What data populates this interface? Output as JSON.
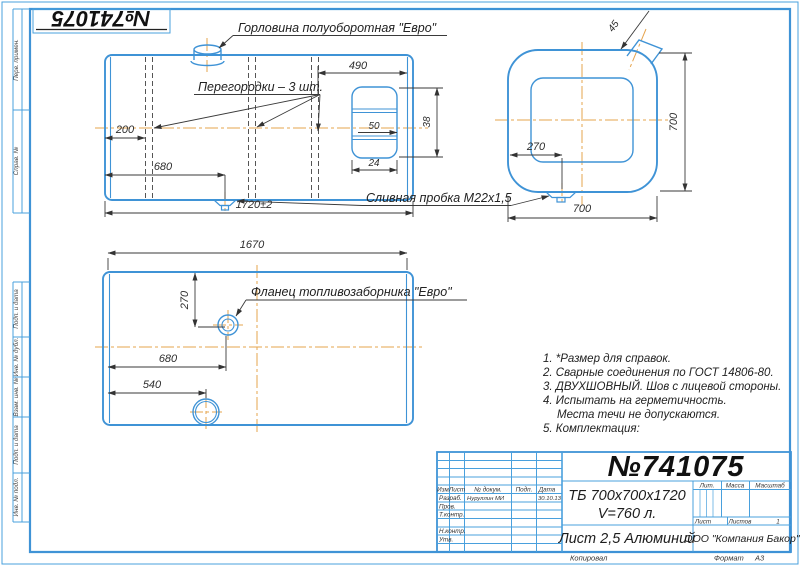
{
  "colors": {
    "line_blue": "#3f93d6",
    "centerline_orange": "#e6a44e",
    "ink": "#333333"
  },
  "page": {
    "stamp_number": "№741075"
  },
  "margin_fields": {
    "top": [
      "Перв. примен.",
      "Справ. №"
    ],
    "bottom": [
      "Подп. и дата",
      "Инв. № дубл.",
      "Взам. инв. №",
      "Подп. и дата",
      "Инв. № подл."
    ]
  },
  "annotations": {
    "neck": "Горловина полуоборотная \"Евро\"",
    "partitions": "Перегородки – 3 шт.",
    "drain_plug": "Сливная пробка М22х1,5",
    "flange": "Фланец топливозаборника \"Евро\""
  },
  "dims": {
    "top_view": {
      "right_span": "490",
      "left_offset": "200",
      "drain_offset": "680",
      "total_length": "1720±2",
      "strap_50": "50",
      "strap_24": "24",
      "strap_38": "38"
    },
    "side_view": {
      "neck": "45",
      "height": "700",
      "width": "700",
      "drain_offset": "270"
    },
    "bottom_view": {
      "length": "1670",
      "flange_from_edge": "270",
      "flange_offset": "680",
      "filler_offset": "540"
    }
  },
  "notes": {
    "lines": [
      "1. *Размер для справок.",
      "2. Сварные соединения по ГОСТ 14806-80.",
      "3. ДВУХШОВНЫЙ. Шов с лицевой стороны.",
      "4. Испытать на герметичность.",
      "Места течи не допускаются.",
      "5. Комплектация:"
    ]
  },
  "title_block": {
    "doc_number": "№741075",
    "designation": "ТБ 700х700х1720",
    "volume": "V=760 л.",
    "material": "Лист 2,5 Алюминий",
    "company": "ООО \"Компания Бакор\"",
    "col_headers": {
      "izm": "Изм",
      "list": "Лист",
      "doc": "№ докум.",
      "podp": "Подп.",
      "data": "Дата"
    },
    "rows": {
      "razrab_label": "Разраб.",
      "razrab_name": "Нуруллин МИ",
      "razrab_date": "30.10.13",
      "prov_label": "Пров.",
      "tkontr_label": "Т.контр.",
      "nkontr_label": "Н.контр.",
      "utv_label": "Утв."
    },
    "props": {
      "lit": "Лит.",
      "mass": "Масса",
      "scale": "Масштаб",
      "sheet": "Лист",
      "sheets": "Листов",
      "sheets_value": "1"
    },
    "footer": {
      "copied": "Копировал",
      "format_label": "Формат",
      "format_value": "А3"
    }
  }
}
